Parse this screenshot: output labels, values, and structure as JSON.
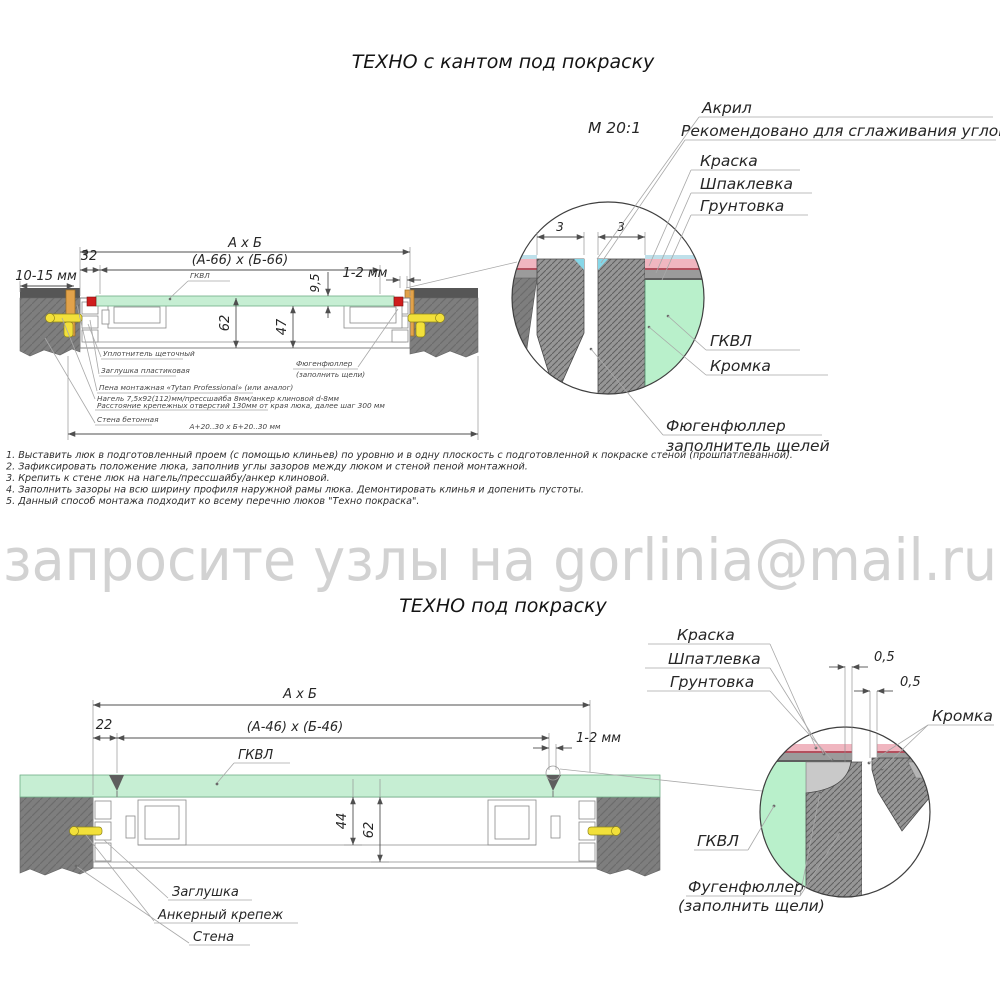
{
  "watermark": {
    "text": "запросите узлы на gorlinia@mail.ru",
    "color": "#d2d2d2"
  },
  "colors": {
    "panel_green": "#c6eed3",
    "detail_green": "#b9f0cb",
    "wall_gray": "#7e7e7e",
    "wall_top": "#565656",
    "kant_red": "#cf1d1d",
    "wedge_orange": "#e2a24a",
    "anchor_yellow": "#f2e03a",
    "paint_pink": "#f0b6c0",
    "paint_red_line": "#b3505e",
    "putty_gray": "#9b9b9b",
    "acryl_cyan": "#86d7e8",
    "filler_gray": "#c9c9c9",
    "blue_film": "#bfe0ea"
  },
  "top_view": {
    "title": "ТЕХНО с кантом под покраску",
    "scale_label": "М 20:1",
    "dims": {
      "outer": "А х Б",
      "inner": "(А-66) х (Б-66)",
      "offset32": "32",
      "wall_gap": "10-15 мм",
      "panel_thick": "9,5",
      "edge_gap": "1-2 мм",
      "frame_h": "62",
      "inner_h": "47",
      "opening": "А+20..30 х Б+20..30 мм",
      "detail_left": "3",
      "detail_right": "3"
    },
    "labels": {
      "acryl": "Акрил",
      "acryl_note": "Рекомендовано для сглаживания углов",
      "paint": "Краска",
      "putty": "Шпаклевка",
      "primer": "Грунтовка",
      "gkvl": "ГКВЛ",
      "gkvl_detail": "ГКВЛ",
      "edge": "Кромка",
      "filler1": "Фюгенфюллер",
      "filler2": "заполнитель щелей",
      "filler_callout1": "Фюгенфюллер",
      "filler_callout2": "(заполнить щели)"
    },
    "callouts": [
      "Уплотнитель щеточный",
      "Заглушка пластиковая",
      "Пена монтажная «Tytan Professional» (или аналог)",
      "Нагель 7,5х92(112)мм/прессшайба 8мм/анкер клиновой d-8мм",
      "Расстояние крепежных отверстий 130мм от края люка, далее шаг 300 мм",
      "Стена бетонная"
    ]
  },
  "notes": [
    "1. Выставить люк в подготовленный проем (с помощью клиньев) по уровню и в одну плоскость с подготовленной к покраске стеной (прошпатлеванной).",
    "2. Зафиксировать положение люка, заполнив углы зазоров между люком и стеной пеной монтажной.",
    "3. Крепить к стене люк на нагель/прессшайбу/анкер клиновой.",
    "4. Заполнить зазоры на всю ширину профиля наружной рамы люка. Демонтировать клинья и допенить пустоты.",
    "5. Данный способ монтажа подходит ко всему перечню люков \"Техно покраска\"."
  ],
  "bottom_view": {
    "title": "ТЕХНО под покраску",
    "dims": {
      "outer": "А х Б",
      "inner": "(А-46) х (Б-46)",
      "offset22": "22",
      "edge_gap": "1-2 мм",
      "inner_h": "44",
      "frame_h": "62",
      "gap_a": "0,5",
      "gap_b": "0,5"
    },
    "labels": {
      "paint": "Краска",
      "putty": "Шпатлевка",
      "primer": "Грунтовка",
      "edge": "Кромка",
      "gkvl": "ГКВЛ",
      "gkvl_detail": "ГКВЛ",
      "filler1": "Фугенфюллер",
      "filler2": "(заполнить щели)",
      "plug": "Заглушка",
      "anchor": "Анкерный крепеж",
      "wall": "Стена"
    }
  }
}
